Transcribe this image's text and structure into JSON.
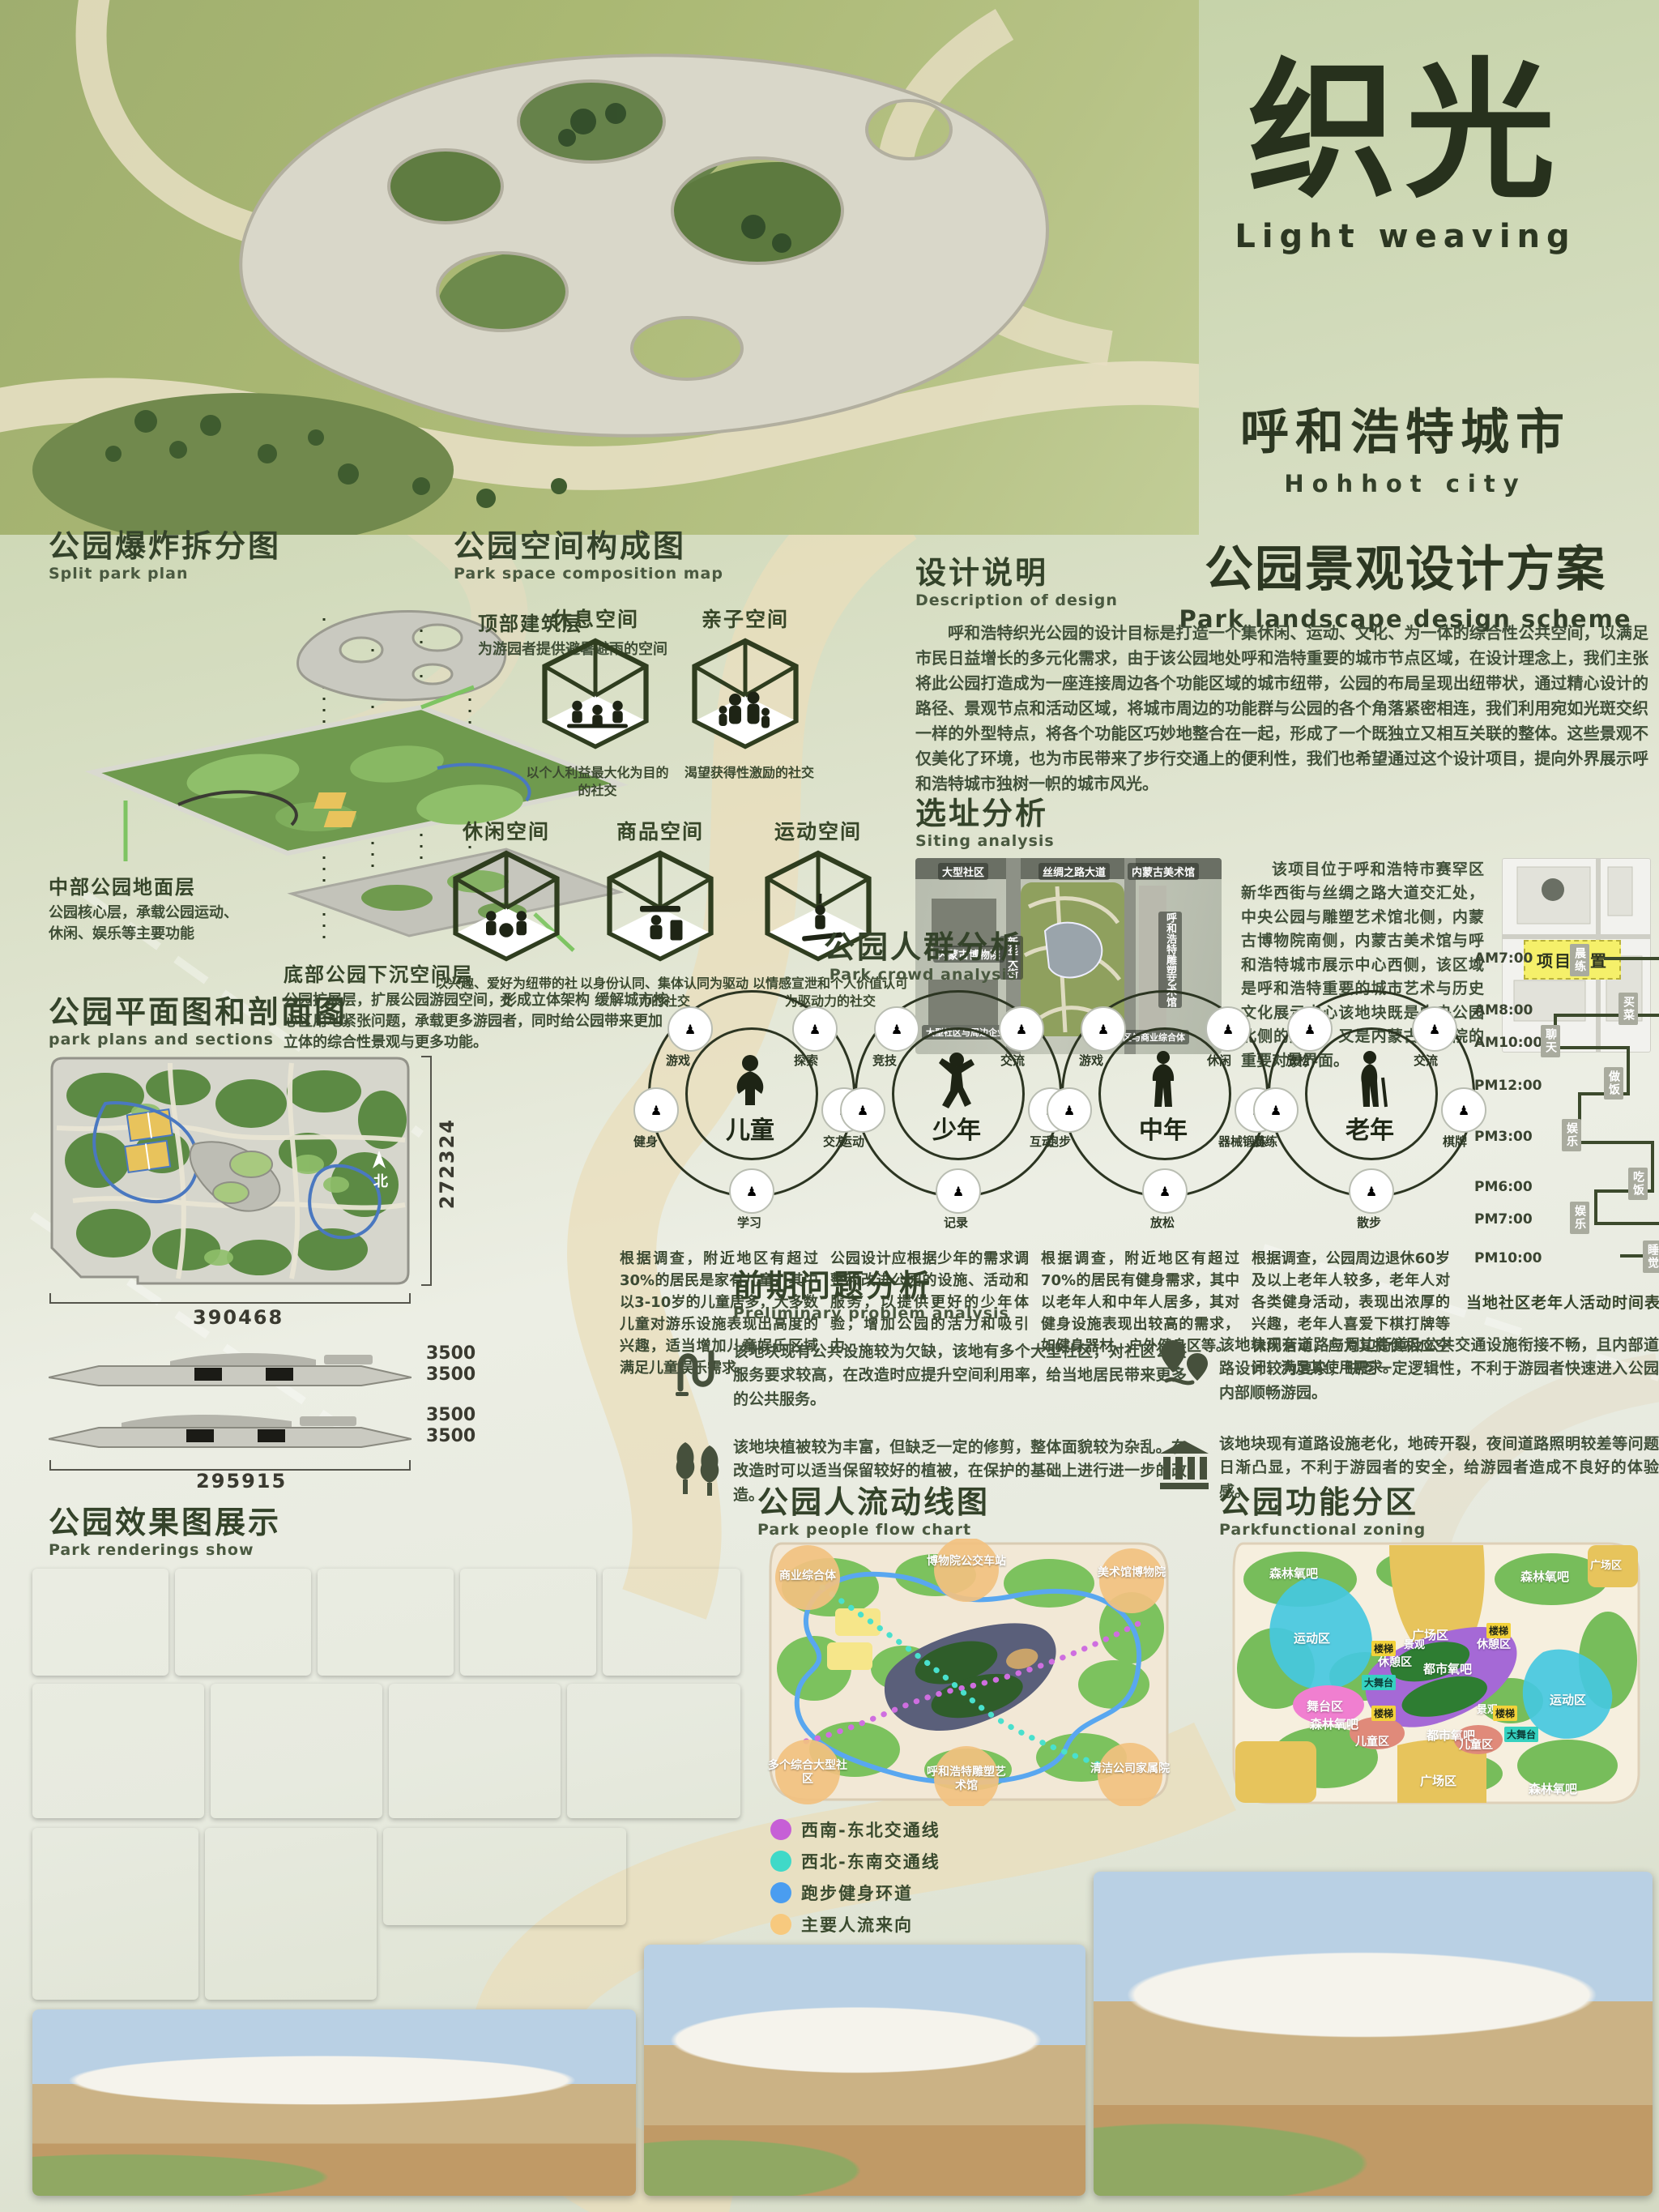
{
  "title": {
    "cn": "织光",
    "en": "Light weaving",
    "city_cn": "呼和浩特城市",
    "city_en": "Hohhot city",
    "scheme_cn": "公园景观设计方案",
    "scheme_en": "Park landscape design scheme"
  },
  "split": {
    "title_cn": "公园爆炸拆分图",
    "title_en": "Split park plan",
    "layers": [
      {
        "name": "顶部建筑层",
        "desc": "为游园者提供避暑避雨的空间"
      },
      {
        "name": "中部公园地面层",
        "desc": "公园核心层，承载公园运动、休闲、娱乐等主要功能"
      },
      {
        "name": "底部公园下沉空间层",
        "desc": "公园扩展层，扩展公园游园空间，形成立体架构 缓解城市核心区用地紧张问题，承载更多游园者，同时给公园带来更加立体的综合性景观与更多功能。"
      }
    ]
  },
  "composition": {
    "title_cn": "公园空间构成图",
    "title_en": "Park space composition map",
    "spaces": [
      {
        "label": "休息空间",
        "desc": "以个人利益最大化为目的的社交"
      },
      {
        "label": "亲子空间",
        "desc": "渴望获得性激励的社交"
      },
      {
        "label": "休闲空间",
        "desc": "以兴趣、爱好为纽带的社交"
      },
      {
        "label": "商品空间",
        "desc": "以身份认同、集体认同为驱动力的社交"
      },
      {
        "label": "运动空间",
        "desc": "以情感宣泄和个人价值认可为驱动力的社交"
      }
    ]
  },
  "design": {
    "title_cn": "设计说明",
    "title_en": "Description of design",
    "body": "呼和浩特织光公园的设计目标是打造一个集休闲、运动、文化、为一体的综合性公共空间，以满足市民日益增长的多元化需求，由于该公园地处呼和浩特重要的城市节点区域，在设计理念上，我们主张将此公园打造成为一座连接周边各个功能区域的城市纽带，公园的布局呈现出纽带状，通过精心设计的路径、景观节点和活动区域，将城市周边的功能群与公园的各个角落紧密相连，我们利用宛如光斑交织一样的外型特点，将各个功能区巧妙地整合在一起，形成了一个既独立又相互关联的整体。这些景观不仅美化了环境，也为市民带来了步行交通上的便利性，我们也希望通过这个设计项目，提向外界展示呼和浩特城市独树一帜的城市风光。"
  },
  "siting": {
    "title_cn": "选址分析",
    "title_en": "Siting analysis",
    "body": "该项目位于呼和浩特市赛罕区新华西街与丝绸之路大道交汇处，中央公园与雕塑艺术馆北侧，内蒙古博物院南侧，内蒙古美术馆与呼和浩特城市展示中心西侧，该区域是呼和浩特重要的城市艺术与历史文化展示中心该地块既是中央公园北侧的起点，又是内蒙古博物院的重要对景界面。",
    "location_tag": "项目位置",
    "map_labels": {
      "community": "大型社区",
      "silk_road": "丝绸之路大道",
      "art_gallery": "内蒙古美术馆",
      "museum": "内蒙古博物院",
      "xinhua_street": "新华大街",
      "sculpture_hall": "呼和浩特雕塑艺术馆",
      "community_enterprise": "大型社区与周边企业单位",
      "community_commercial": "大型社区与商业综合体"
    }
  },
  "crowd": {
    "title_cn": "公园人群分析",
    "title_en": "Park crowd analysis",
    "groups": [
      {
        "center": "儿童",
        "orbits": [
          "游戏",
          "探索",
          "健身",
          "交友",
          "学习"
        ],
        "desc": "根据调查，附近地区有超过30%的居民是家有儿童，其中以3-10岁的儿童居多，大多数儿童对游乐设施表现出高度的兴趣，适当增加儿童娱乐区域满足儿童娱乐需求。"
      },
      {
        "center": "少年",
        "orbits": [
          "竞技",
          "交流",
          "运动",
          "互动",
          "记录"
        ],
        "desc": "公园设计应根据少年的需求调整和改进公园的设施、活动和服务，以提供更好的少年体验，增加公园的活力和吸引力。"
      },
      {
        "center": "中年",
        "orbits": [
          "游戏",
          "休闲",
          "跑步",
          "器械锻炼",
          "放松"
        ],
        "desc": "根据调查，附近地区有超过70%的居民有健身需求，其中以老年人和中年人居多，其对健身设施表现出较高的需求，如健身器材、户外健身区等。"
      },
      {
        "center": "老年",
        "orbits": [
          "放松",
          "交流",
          "晨练",
          "棋牌",
          "散步"
        ],
        "desc": "根据调查，公园周边退休60岁及以上老年人较多，老年人对各类健身活动，表现出浓厚的兴趣，老年人喜爱下棋打牌等休闲活动，应为其提供相应空间，满足其使用需求。"
      }
    ],
    "timetable": {
      "caption": "当地社区老年人活动时间表",
      "rows": [
        {
          "time": "AM7:00",
          "activity": "晨练"
        },
        {
          "time": "AM8:00",
          "activity": "买菜"
        },
        {
          "time": "AM10:00",
          "activity": "聊天"
        },
        {
          "time": "PM12:00",
          "activity": "做饭"
        },
        {
          "time": "PM3:00",
          "activity": "娱乐"
        },
        {
          "time": "PM6:00",
          "activity": "吃饭"
        },
        {
          "time": "PM7:00",
          "activity": "娱乐"
        },
        {
          "time": "PM10:00",
          "activity": "睡觉"
        }
      ]
    }
  },
  "plan": {
    "title_cn": "公园平面图和剖面图",
    "title_en": "park plans and sections",
    "width_dim": "390468",
    "height_dim": "272324",
    "section_dim": "295915",
    "floor_height": "3500",
    "north": "北"
  },
  "problems": {
    "title_cn": "前期问题分析",
    "title_en": "Preliminary problem analysis",
    "items": [
      {
        "icon": "winding-path-icon",
        "text": "该地块现有公共设施较为欠缺，该地有多个大型社区，对社区公共服务要求较高，在改造时应提升空间利用率，给当地居民带来更多的公共服务。"
      },
      {
        "icon": "trees-icon",
        "text": "该地块植被较为丰富，但缺乏一定的修剪，整体面貌较为杂乱。在改造时可以适当保留较好的植被，在保护的基础上进行进一步的改造。"
      },
      {
        "icon": "map-pins-icon",
        "text": "该地块现有道路与周边街道及公共交通设施衔接不畅，且内部道路设计较为复杂，缺乏一定逻辑性，不利于游园者快速进入公园内部顺畅游园。"
      },
      {
        "icon": "bank-icon",
        "text": "该地块现有道路设施老化，地砖开裂，夜间道路照明较差等问题日渐凸显，不利于游园者的安全，给游园者造成不良好的体验感。"
      }
    ]
  },
  "renderings": {
    "title_cn": "公园效果图展示",
    "title_en": "Park renderings show"
  },
  "flow": {
    "title_cn": "公园人流动线图",
    "title_en": "Park people flow chart",
    "legend": [
      {
        "color": "#c65fd6",
        "label": "西南-东北交通线"
      },
      {
        "color": "#3fd9c8",
        "label": "西北-东南交通线"
      },
      {
        "color": "#4a9df0",
        "label": "跑步健身环道"
      },
      {
        "color": "#f7c97e",
        "label": "主要人流来向"
      }
    ],
    "nodes": [
      "商业综合体",
      "博物院公交车站",
      "美术馆博物院",
      "多个综合大型社区",
      "呼和浩特雕塑艺术馆",
      "清洁公司家属院"
    ]
  },
  "zoning": {
    "title_cn": "公园功能分区",
    "title_en": "Parkfunctional zoning",
    "labels": {
      "forest": "森林氧吧",
      "plaza": "广场区",
      "sport": "运动区",
      "stage": "舞台区",
      "rest": "休憩区",
      "kids": "儿童区",
      "urban_o2": "都市氧吧",
      "view": "景观",
      "stairs": "楼梯",
      "big_stage": "大舞台"
    }
  }
}
